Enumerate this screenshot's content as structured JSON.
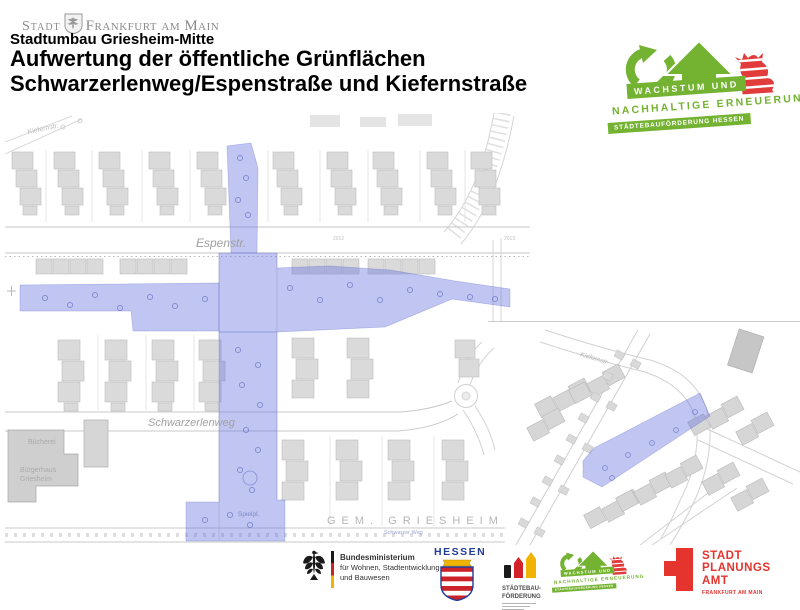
{
  "colors": {
    "green": "#74b232",
    "blue": "#6a76dd",
    "hessen_blue": "#1f3d99",
    "red": "#e5332e"
  },
  "header": {
    "city_prefix": "Stadt",
    "city_name": "Frankfurt am Main",
    "subtitle": "Stadtumbau Griesheim-Mitte",
    "title_line1": "Aufwertung der öffentliche Grünflächen",
    "title_line2": "Schwarzerlenweg/Espenstraße und Kiefernstraße"
  },
  "program_logo": {
    "line1": "WACHSTUM UND",
    "line2": "NACHHALTIGE ERNEUERUNG",
    "line3": "STÄDTEBAUFÖRDERUNG HESSEN"
  },
  "map": {
    "street_espenstrasse": "Espenstr.",
    "street_kiefernstr_top": "Kiefernstr.",
    "street_schwarzerlenweg": "Schwarzerlenweg",
    "street_schwarzer_weg": "Schwarzer Weg",
    "street_kiefernstr_inset": "Kiefernstr.",
    "label_buecherei": "Bücherei",
    "label_buergerhaus_1": "Bürgerhaus",
    "label_buergerhaus_2": "Griesheim",
    "label_spielplatz": "Spielpl.",
    "label_gemarkung": "GEM. GRIESHEIM",
    "parcel_a": "2012",
    "parcel_b": "2013"
  },
  "footer": {
    "bund_line1": "Bundesministerium",
    "bund_line2": "für Wohnen, Stadtentwicklung",
    "bund_line3": "und Bauwesen",
    "hessen_label": "HESSEN",
    "staedtebau_line1": "STÄDTEBAU-",
    "staedtebau_line2": "FÖRDERUNG",
    "spa_line1": "STADT",
    "spa_line2": "PLANUNGS",
    "spa_line3": "AMT",
    "spa_line4": "FRANKFURT AM MAIN"
  }
}
